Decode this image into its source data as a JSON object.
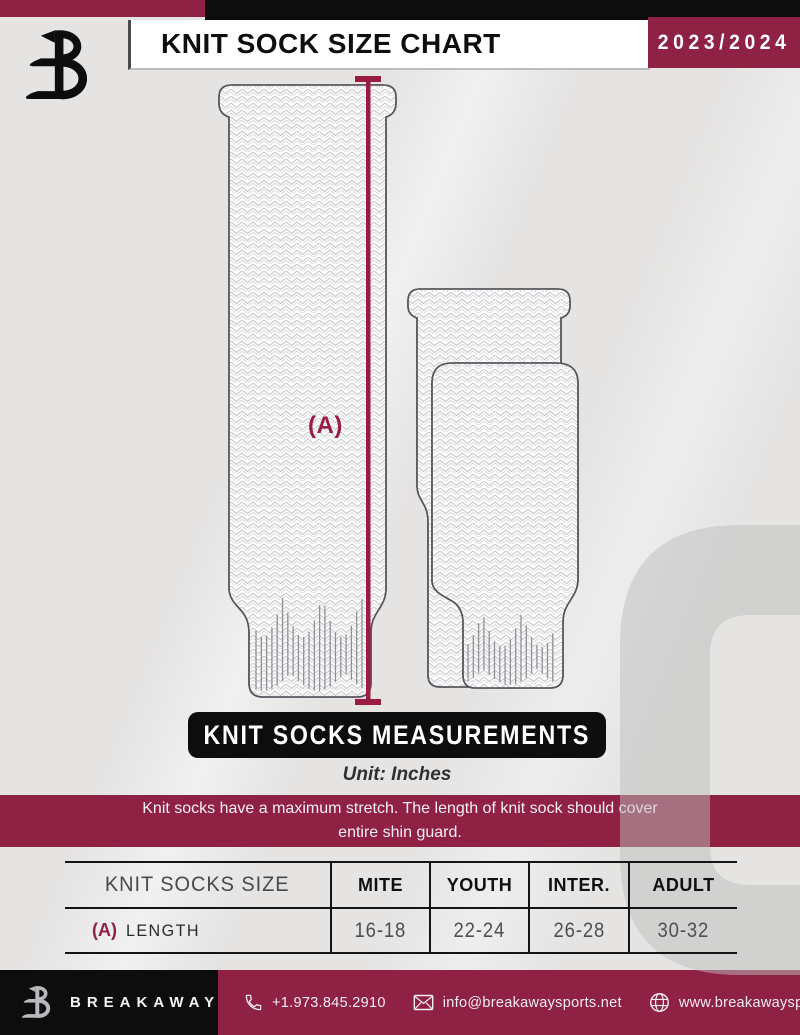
{
  "colors": {
    "background": "#e5e4e3",
    "accent_maroon": "#8e2144",
    "measure_line": "#9b1c42",
    "panel_black": "#0d0d0d",
    "watermark_gray": "#bfbfbf"
  },
  "header": {
    "title": "KNIT SOCK SIZE CHART",
    "season": "2023/2024"
  },
  "diagram": {
    "measure_label": "(A)"
  },
  "measurements": {
    "banner_title": "KNIT SOCKS MEASUREMENTS",
    "unit_label": "Unit: Inches",
    "note_line1": "Knit socks have a maximum stretch. The length of knit sock should cover",
    "note_line2": "entire shin guard."
  },
  "size_table": {
    "row_header": "KNIT SOCKS SIZE",
    "columns": [
      "MITE",
      "YOUTH",
      "INTER.",
      "ADULT"
    ],
    "rows": [
      {
        "ref": "(A)",
        "label": "LENGTH",
        "values": [
          "16-18",
          "22-24",
          "26-28",
          "30-32"
        ]
      }
    ]
  },
  "footer": {
    "brand": "BREAKAWAY",
    "phone": "+1.973.845.2910",
    "email": "info@breakawaysports.net",
    "website": "www.breakawaysports.net"
  }
}
